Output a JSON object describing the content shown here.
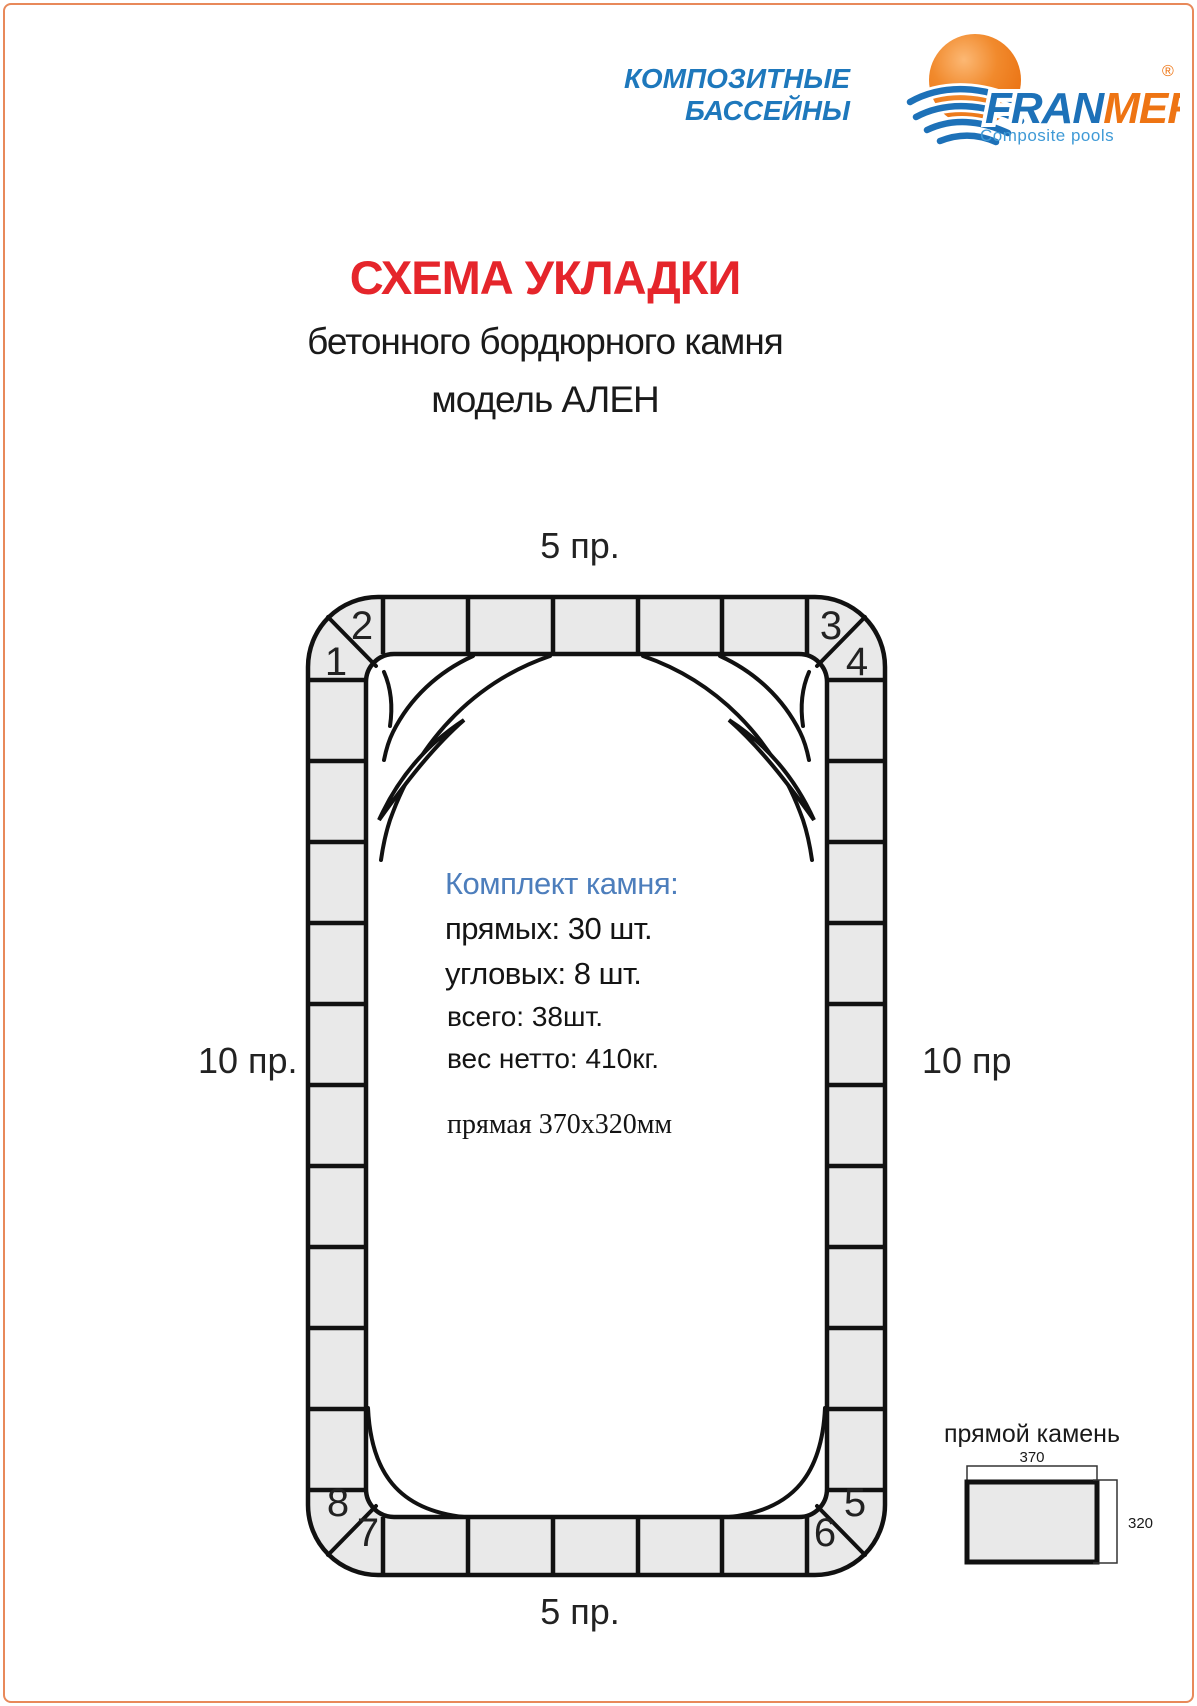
{
  "logo": {
    "tagline1": "КОМПОЗИТНЫЕ",
    "tagline2": "БАССЕЙНЫ",
    "brand_fran": "FRAN",
    "brand_mer": "MER",
    "registered": "®",
    "subtitle": "Composite pools",
    "colors": {
      "blue": "#1d71b8",
      "orange": "#ee7413",
      "light_blue": "#3f9ad6"
    }
  },
  "title": {
    "heading": "СХЕМА УКЛАДКИ",
    "sub1": "бетонного бордюрного камня",
    "sub2": "модель АЛЕН",
    "heading_color": "#e5252b"
  },
  "diagram": {
    "labels": {
      "top": "5 пр.",
      "left": "10 пр.",
      "right": "10 пр.",
      "bottom": "5 пр."
    },
    "corners": {
      "n1": "1",
      "n2": "2",
      "n3": "3",
      "n4": "4",
      "n5": "5",
      "n6": "6",
      "n7": "7",
      "n8": "8"
    },
    "stone_fill": "#e9e9e9",
    "line_color": "#111111"
  },
  "kit": {
    "title": "Комплект камня:",
    "straight": "прямых: 30 шт.",
    "corner": "угловых: 8 шт.",
    "total": "всего: 38шт.",
    "weight": "вес нетто: 410кг.",
    "dimension": "прямая 370х320мм"
  },
  "stone_detail": {
    "title": "прямой камень",
    "width_label": "370",
    "height_label": "320"
  },
  "page": {
    "border_color": "#e8895a"
  }
}
